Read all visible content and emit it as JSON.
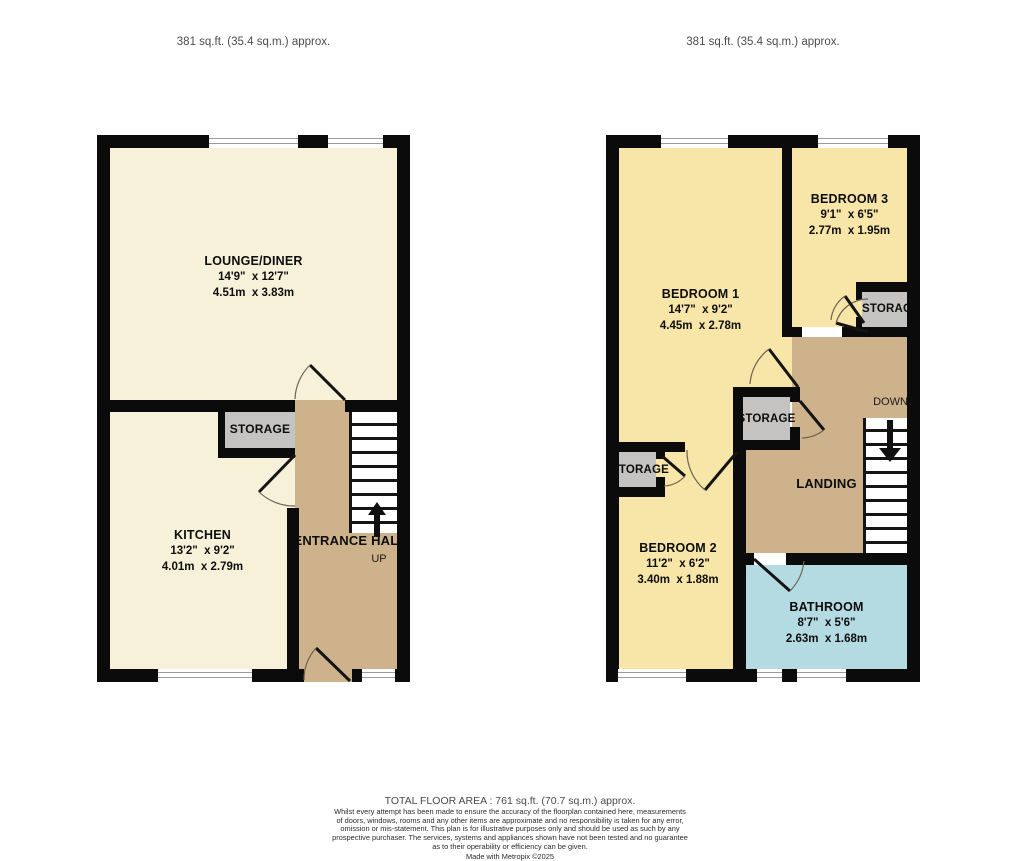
{
  "headers": {
    "ground_area": "381 sq.ft. (35.4 sq.m.) approx.",
    "first_area": "381 sq.ft. (35.4 sq.m.) approx."
  },
  "ground_floor": {
    "lounge_diner": {
      "name": "LOUNGE/DINER",
      "imperial": "14'9\"  x 12'7\"",
      "metric": "4.51m  x 3.83m"
    },
    "kitchen": {
      "name": "KITCHEN",
      "imperial": "13'2\"  x 9'2\"",
      "metric": "4.01m  x 2.79m"
    },
    "storage": {
      "name": "STORAGE"
    },
    "entrance_hall": {
      "name": "ENTRANCE HALL",
      "stairs_direction": "UP"
    }
  },
  "first_floor": {
    "bedroom_1": {
      "name": "BEDROOM 1",
      "imperial": "14'7\"  x 9'2\"",
      "metric": "4.45m  x 2.78m"
    },
    "bedroom_2": {
      "name": "BEDROOM 2",
      "imperial": "11'2\"  x 6'2\"",
      "metric": "3.40m  x 1.88m"
    },
    "bedroom_3": {
      "name": "BEDROOM 3",
      "imperial": "9'1\"  x 6'5\"",
      "metric": "2.77m  x 1.95m"
    },
    "bathroom": {
      "name": "BATHROOM",
      "imperial": "8'7\"  x 5'6\"",
      "metric": "2.63m  x 1.68m"
    },
    "landing": {
      "name": "LANDING",
      "stairs_direction": "DOWN"
    },
    "storage_top": {
      "name": "STORAGE"
    },
    "storage_middle": {
      "name": "STORAGE"
    },
    "storage_left": {
      "name": "STORAGE"
    }
  },
  "footer": {
    "total_area": "TOTAL FLOOR AREA : 761 sq.ft. (70.7 sq.m.) approx.",
    "disclaimer": [
      "Whilst every attempt has been made to ensure the accuracy of the floorplan contained here, measurements",
      "of doors, windows, rooms and any other items are approximate and no responsibility is taken for any error,",
      "omission or mis-statement. This plan is for illustrative purposes only and should be used as such by any",
      "prospective purchaser. The services, systems and appliances shown have not been tested and no guarantee",
      "as to their operability or efficiency can be given."
    ],
    "credit": "Made with Metropix ©2025"
  },
  "colors": {
    "room_cream": "#f7f1da",
    "room_yellow": "#f8e6a8",
    "hall_tan": "#cdb28c",
    "bath_blue": "#b5dbe2",
    "storage_grey": "#c4c3c2",
    "wall": "#0b0b0b"
  }
}
